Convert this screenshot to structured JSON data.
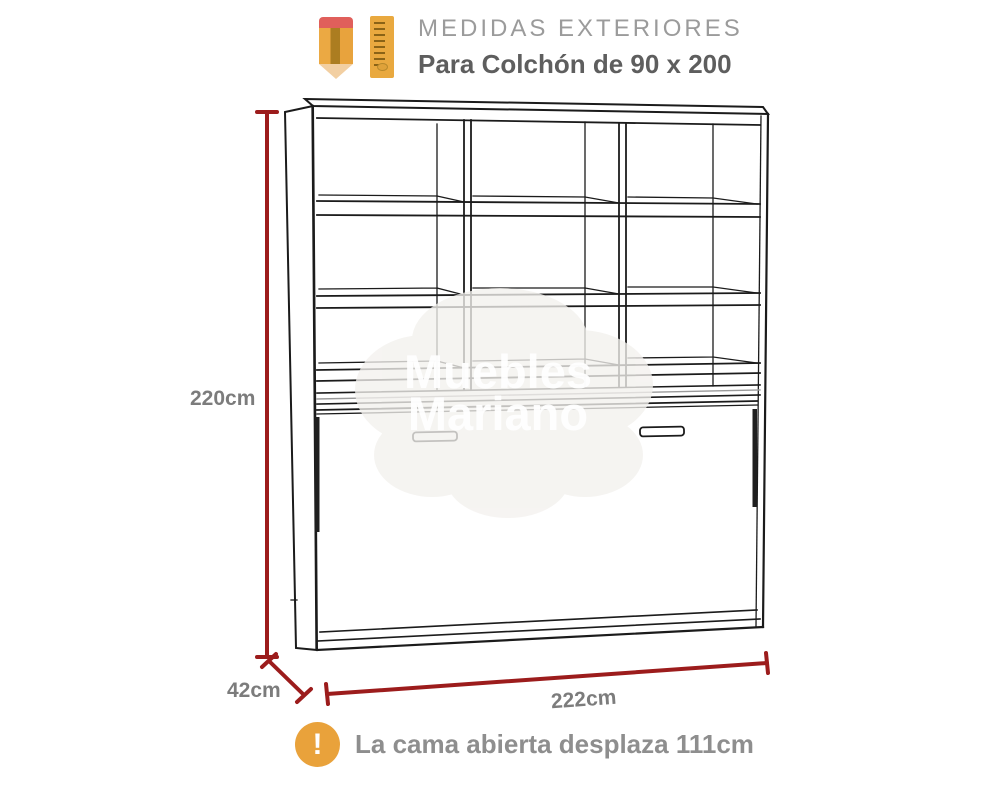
{
  "header": {
    "title": "MEDIDAS EXTERIORES",
    "subtitle": "Para Colchón de 90 x 200",
    "icons": [
      "pencil-icon",
      "ruler-icon"
    ]
  },
  "dimensions": {
    "height_label": "220cm",
    "depth_label": "42cm",
    "width_label": "222cm",
    "height_cm": 220,
    "depth_cm": 42,
    "width_cm": 222
  },
  "note": {
    "icon": "warning-icon",
    "icon_glyph": "!",
    "text": "La cama abierta desplaza 111cm",
    "displacement_cm": 111
  },
  "watermark": {
    "line1": "Muebles",
    "line2": "Mariano"
  },
  "colors": {
    "dimension_red": "#9c1c1c",
    "label_gray": "#7c7c7c",
    "note_orange": "#e9a23b",
    "drawing_line": "#1b1b1b"
  }
}
